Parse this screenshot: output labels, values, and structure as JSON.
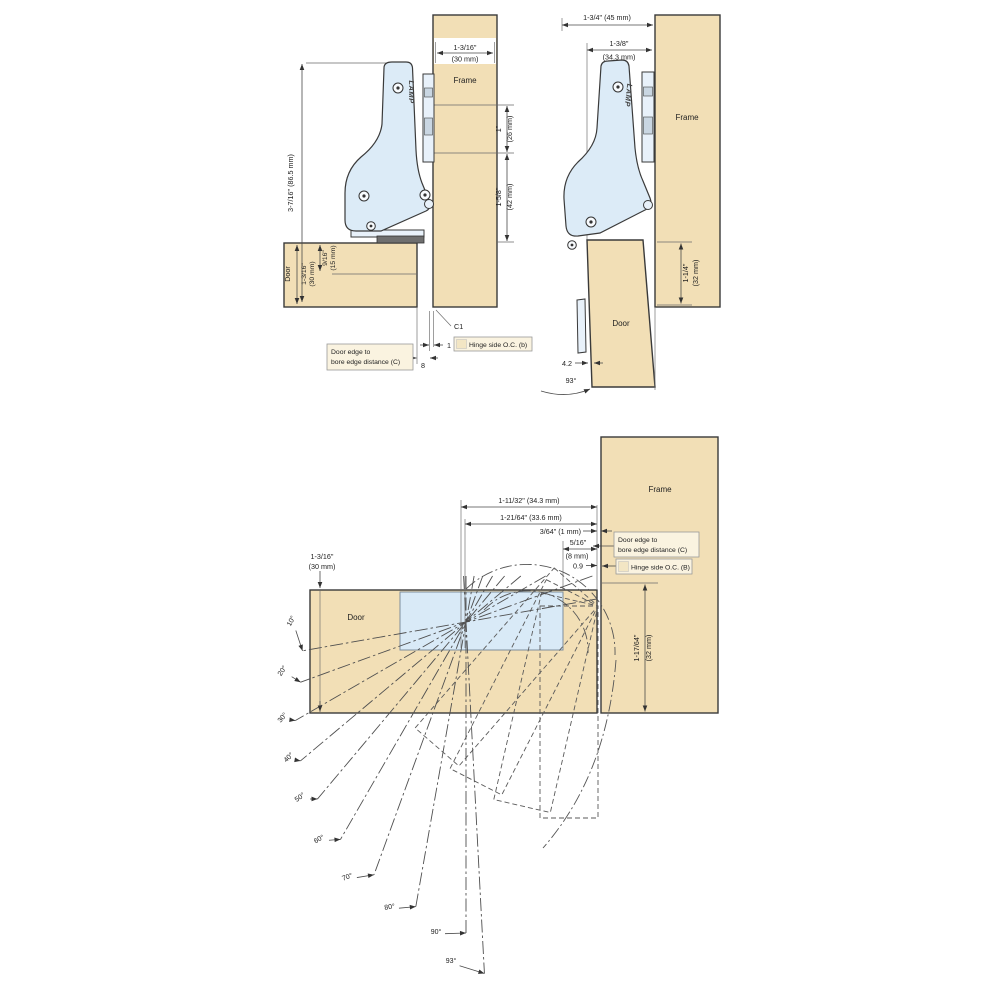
{
  "colors": {
    "wood": "#f2dfb6",
    "hinge_body": "#dcebf7",
    "recess": "#d9eaf7",
    "cup": "#6f6f6f",
    "label_box_bg": "#faf3e0",
    "outline": "#3a3a3a"
  },
  "top_left": {
    "frame_label": "Frame",
    "frame_width_in": "1-3/16\"",
    "frame_width_mm": "(30 mm)",
    "arm_height": "3-7/16\" (86.5 mm)",
    "hole_spacing_in": "1\"",
    "hole_spacing_mm": "(26 mm)",
    "hole_to_door_in": "1-5/8\"",
    "hole_to_door_mm": "(42 mm)",
    "door_label": "Door",
    "door_thickness_in": "1-3/16\"",
    "door_thickness_mm": "(30 mm)",
    "bore_depth_in": "9/16\"",
    "bore_depth_mm": "(15 mm)",
    "cup_ref": "C1",
    "gap_value": "1",
    "bore_distance_value": "8",
    "door_edge_box_line1": "Door edge to",
    "door_edge_box_line2": "bore edge distance (C)",
    "oc_box": "Hinge side O.C. (b)",
    "logo": "LAMP"
  },
  "top_right": {
    "overlay_width": "1-3/4\" (45 mm)",
    "bore_center_in": "1-3/8\"",
    "bore_center_mm": "(34.3 mm)",
    "frame_label": "Frame",
    "door_label": "Door",
    "below_frame_in": "1-1/4\"",
    "below_frame_mm": "(32 mm)",
    "protrusion": "4.2",
    "open_angle": "93°",
    "logo": "LAMP"
  },
  "bottom": {
    "frame_label": "Frame",
    "door_label": "Door",
    "dim_34_3": "1-11/32\" (34.3 mm)",
    "dim_33_6": "1-21/64\" (33.6 mm)",
    "dim_1mm": "3/64\" (1 mm)",
    "dim_8mm_in": "5/16\"",
    "dim_8mm_mm": "(8 mm)",
    "dim_0_9": "0.9",
    "door_edge_box_line1": "Door edge to",
    "door_edge_box_line2": "bore edge distance (C)",
    "oc_box": "Hinge side O.C. (B)",
    "door_thickness_in": "1-3/16\"",
    "door_thickness_mm": "(30 mm)",
    "frame_below_in": "1-17/64\"",
    "frame_below_mm": "(32 mm)",
    "angle_labels": [
      "10°",
      "20°",
      "30°",
      "40°",
      "50°",
      "60°",
      "70°",
      "80°",
      "90°",
      "93°"
    ]
  }
}
